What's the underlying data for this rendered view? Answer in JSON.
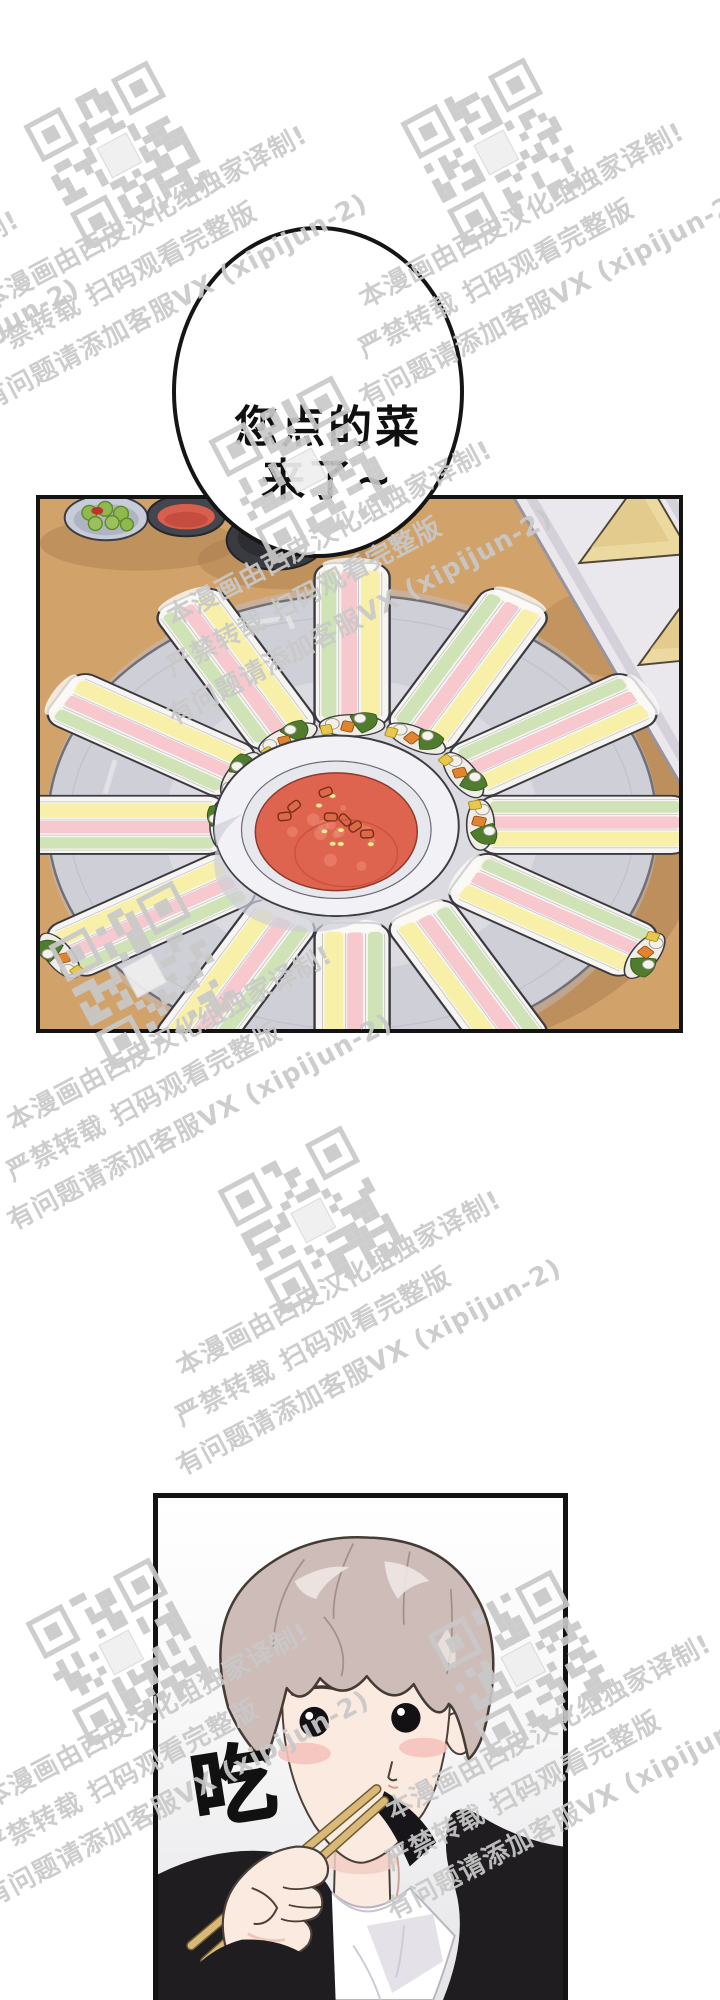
{
  "comic": {
    "speech_bubble": {
      "line1": "您点的菜",
      "line2": "来了~"
    },
    "sfx_eat": "吃"
  },
  "watermark": {
    "line1": "本漫画由西皮汉化组独家译制!",
    "line2": "严禁转载 扫码观看完整版",
    "line3": "有问题请添加客服VX (xipijun-2)"
  },
  "colors": {
    "panel_border": "#131313",
    "table_wood": "#d2a26b",
    "plate": "#dbdbe1",
    "dip_sauce": "#df6450",
    "roll_green": "#cfe3b6",
    "roll_pink": "#f7c9cf",
    "roll_yellow": "#f8f0a8",
    "tray_triangle": "#ebd9a0",
    "hair": "#cdbcb8",
    "skin": "#fbeae0",
    "blush": "#f5c3bc",
    "jacket_black": "#1f1d20",
    "chopstick": "#d9b878",
    "watermark_gray": "#c9c9c9"
  }
}
